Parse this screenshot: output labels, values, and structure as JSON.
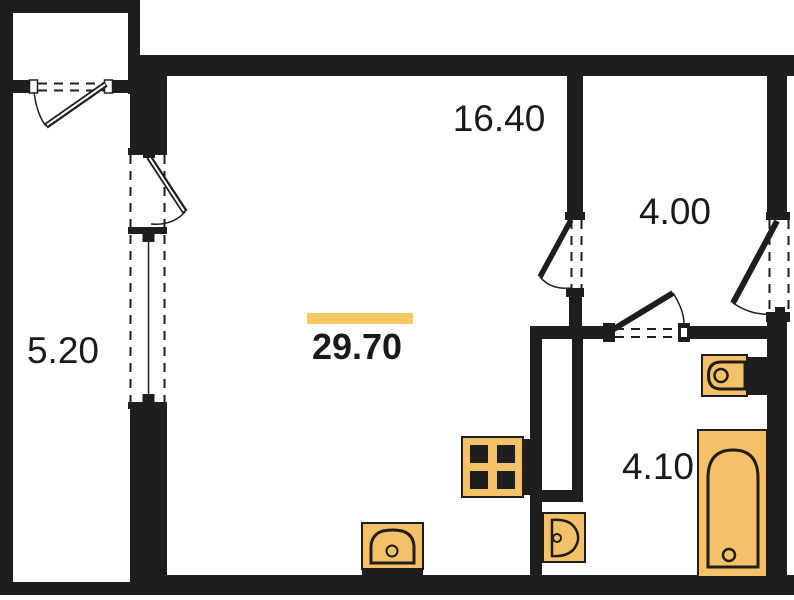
{
  "plan": {
    "total_area": {
      "value": "29.70",
      "highlighted": true
    },
    "rooms": [
      {
        "name": "balcony",
        "area": "5.20"
      },
      {
        "name": "living-room",
        "area": "16.40"
      },
      {
        "name": "hallway",
        "area": "4.00"
      },
      {
        "name": "bathroom",
        "area": "4.10"
      }
    ],
    "fixtures": [
      "stove-icon",
      "kitchen-sink-icon",
      "washbasin-icon",
      "toilet-icon",
      "bathtub-icon"
    ],
    "colors": {
      "walls": "#1e1e1e",
      "fixtures": "#F5C168",
      "highlight_bar": "#FAC863",
      "text": "#1a1a1a",
      "background": "#ffffff"
    }
  }
}
